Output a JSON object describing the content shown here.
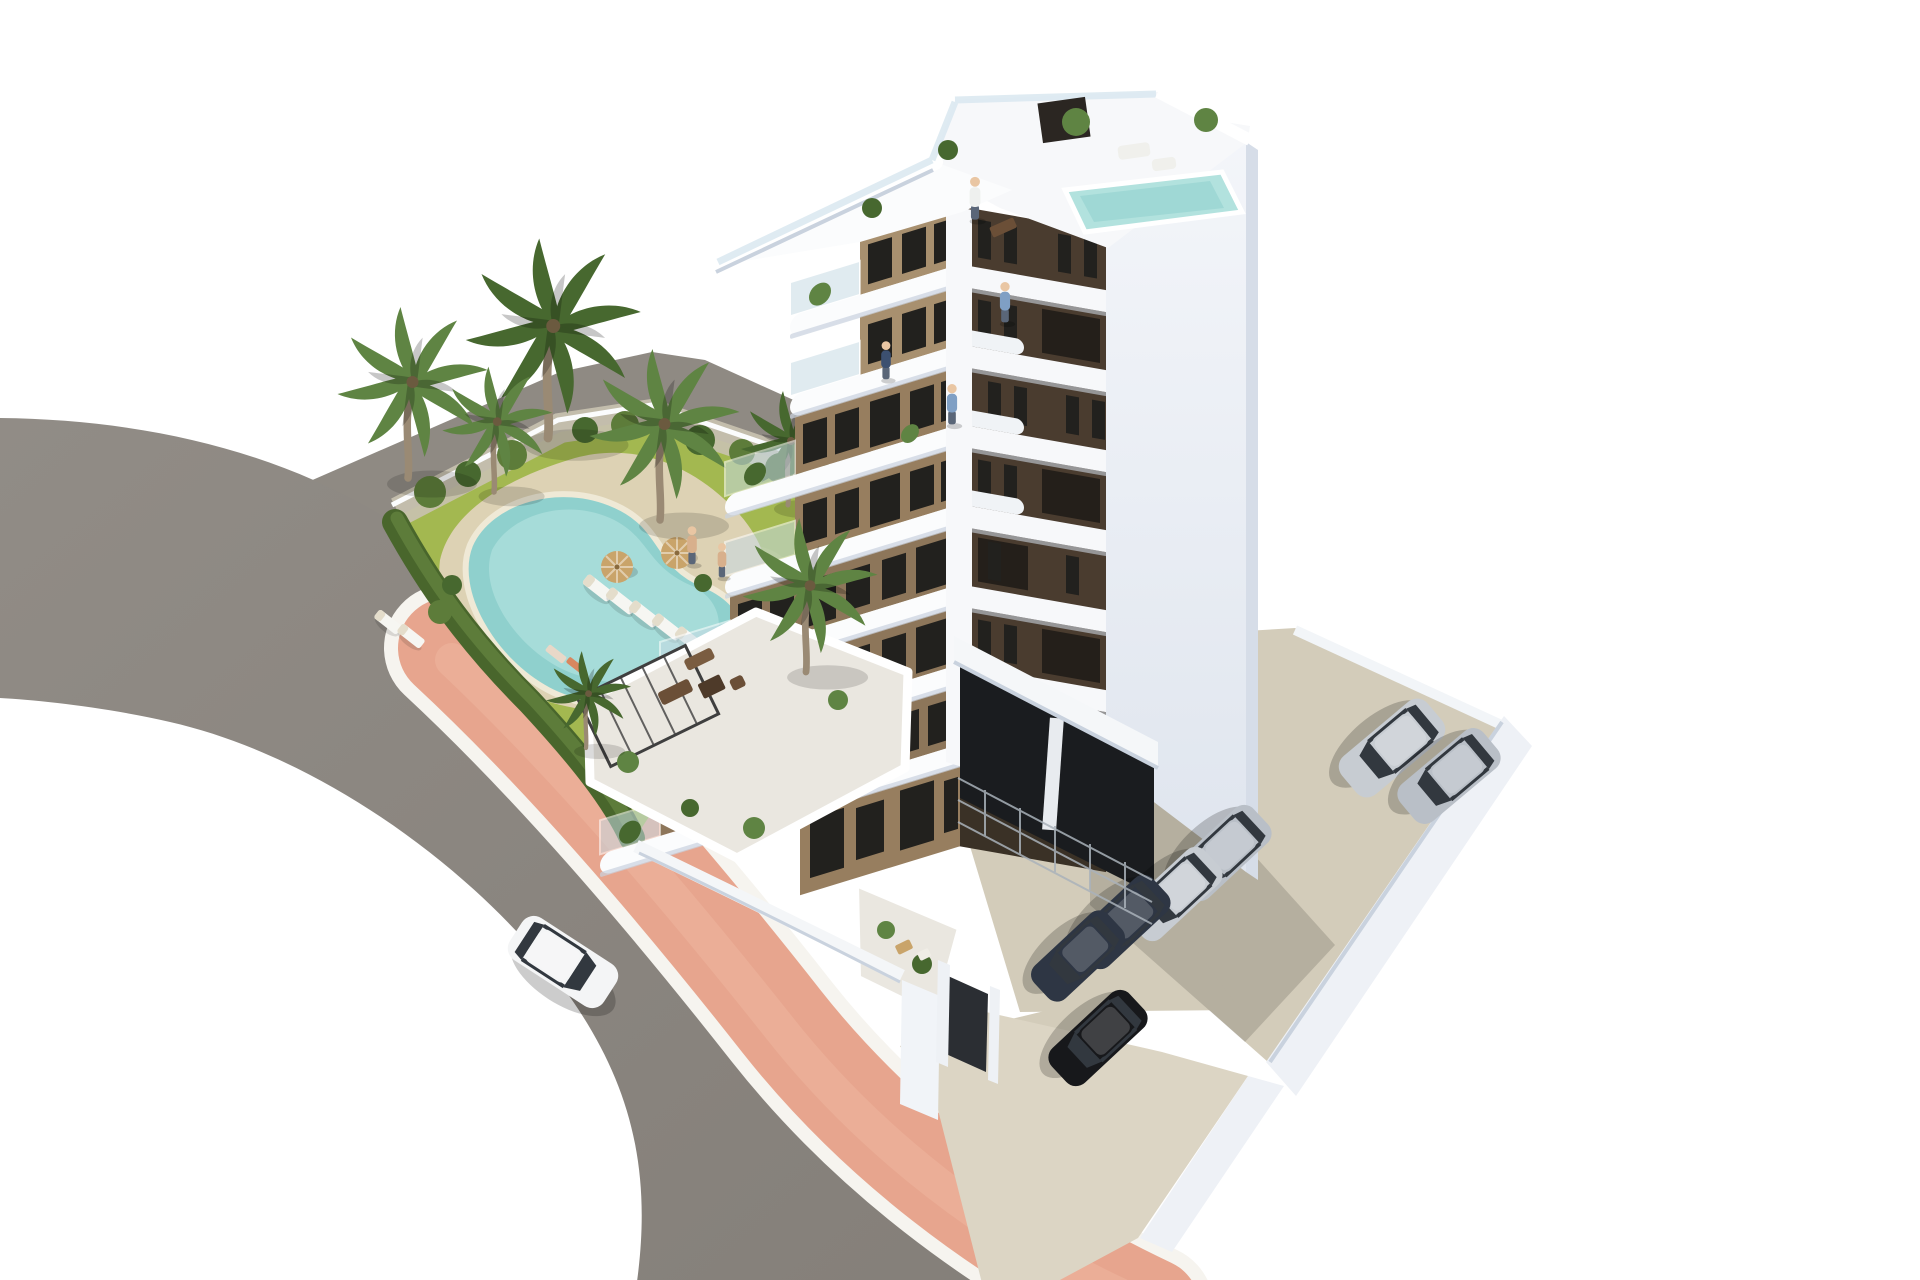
{
  "scene": {
    "type": "architectural-3d-render",
    "description": "Aerial 3D render of a modern 8-storey white and brown apartment building with stepped curved balconies, roof terraces with plunge pool, a landscaped garden with free-form swimming pool, sun loungers, parasols and palm trees, a curved asphalt road with pink sidewalk, a white car driving, and a walled parking court with parked cars and a semi-open garage."
  },
  "palette": {
    "bg": "#ffffff",
    "road": "#8b8680",
    "road_light": "#938e88",
    "strip": "#8f8a83",
    "sidewalk": "#e7a58e",
    "sidewalk_light": "#efb7a0",
    "curb": "#f6f4ef",
    "lawn": "#a3b850",
    "lawn_light": "#bcca6a",
    "gravel": "#c9c2b0",
    "hedge_dark": "#49662c",
    "hedge": "#5d7c3a",
    "deck": "#ddd2b4",
    "pool": "#8fd0cd",
    "pool_light": "#b2e2de",
    "pool_rim": "#efe9d6",
    "palm": "#5f8443",
    "palm_dark": "#47682f",
    "trunk": "#9a8a74",
    "white_wall": "#f7f8fa",
    "white_shade": "#c9d2de",
    "side_wall": "#eef1f6",
    "side_wall_shade": "#d6dde8",
    "tan": "#977e5f",
    "tan_light": "#a8906f",
    "tan_deep": "#8d765a",
    "dark_face": "#4a3c2f",
    "dark_face_deep": "#3a3126",
    "window": "#22211e",
    "glass": "#c8dbe4",
    "terrace_floor": "#eae7e0",
    "garage": "#1a1c1f",
    "yard": "#d3ccba",
    "yard_light": "#dcd5c4",
    "car_white": "#f4f5f6",
    "car_silver": "#c7ccd2",
    "car_silver2": "#b9bfc7",
    "car_navy": "#2e3644",
    "car_black": "#17181b",
    "wood": "#6b4f37",
    "wood_light": "#7a5c40",
    "umbrella": "#c9a46a",
    "person_blue": "#7f9fc4",
    "person_white": "#eef0ee",
    "person_navy": "#3c5070",
    "person_tan": "#d8b08c"
  },
  "inventory": {
    "building_floors": 8,
    "roof_features": [
      "roof terrace",
      "plunge pool",
      "glass balustrades",
      "potted plants"
    ],
    "garden": {
      "swimming_pool": 1,
      "sun_loungers": 7,
      "parasols": 2,
      "palm_trees": 7,
      "hedge": true
    },
    "road": {
      "cars_driving": 1,
      "sidewalk_color": "pink"
    },
    "parking": {
      "cars_parked": 7,
      "garage": "semi-open with car stackers"
    }
  },
  "instances": [
    {
      "use": "tpl-lounger",
      "name": "sun-lounger",
      "layer": "layer-garden-furniture",
      "x": 598,
      "y": 588,
      "r": 38
    },
    {
      "use": "tpl-lounger",
      "name": "sun-lounger",
      "layer": "layer-garden-furniture",
      "x": 621,
      "y": 601,
      "r": 38
    },
    {
      "use": "tpl-lounger",
      "name": "sun-lounger",
      "layer": "layer-garden-furniture",
      "x": 644,
      "y": 614,
      "r": 38
    },
    {
      "use": "tpl-lounger",
      "name": "sun-lounger",
      "layer": "layer-garden-furniture",
      "x": 667,
      "y": 627,
      "r": 38
    },
    {
      "use": "tpl-lounger",
      "name": "sun-lounger",
      "layer": "layer-garden-furniture",
      "x": 690,
      "y": 640,
      "r": 38
    },
    {
      "use": "tpl-lounger",
      "name": "sun-lounger",
      "layer": "layer-garden-furniture",
      "x": 388,
      "y": 622,
      "r": 38,
      "s": 0.9
    },
    {
      "use": "tpl-lounger",
      "name": "sun-lounger",
      "layer": "layer-garden-furniture",
      "x": 411,
      "y": 636,
      "r": 38,
      "s": 0.9
    },
    {
      "use": "tpl-umbrella",
      "name": "parasol",
      "layer": "layer-garden-furniture",
      "x": 617,
      "y": 567,
      "fill": "umbrella"
    },
    {
      "use": "tpl-umbrella",
      "name": "parasol",
      "layer": "layer-garden-furniture",
      "x": 677,
      "y": 553,
      "fill": "umbrella"
    },
    {
      "use": "tpl-palm",
      "name": "palm-tree",
      "layer": "layer-garden-flora",
      "x": 408,
      "y": 478,
      "s": 1.5,
      "fill": "palm"
    },
    {
      "use": "tpl-palm",
      "name": "palm-tree",
      "layer": "layer-garden-flora",
      "x": 548,
      "y": 438,
      "s": 1.75,
      "fill": "palm_dark"
    },
    {
      "use": "tpl-palm",
      "name": "palm-tree",
      "layer": "layer-garden-flora",
      "x": 494,
      "y": 492,
      "s": 1.1,
      "fill": "palm"
    },
    {
      "use": "tpl-palm",
      "name": "palm-tree",
      "layer": "layer-garden-flora",
      "x": 660,
      "y": 520,
      "s": 1.5,
      "fill": "palm"
    },
    {
      "use": "tpl-palm",
      "name": "palm-tree",
      "layer": "layer-garden-flora",
      "x": 788,
      "y": 505,
      "s": 1.0,
      "fill": "palm_dark"
    },
    {
      "use": "tpl-palm",
      "name": "palm-tree",
      "layer": "layer-front-flora",
      "x": 806,
      "y": 672,
      "s": 1.35,
      "fill": "palm"
    },
    {
      "use": "tpl-palm",
      "name": "palm-tree",
      "layer": "layer-front-flora",
      "x": 586,
      "y": 748,
      "s": 0.85,
      "fill": "palm_dark"
    },
    {
      "use": "tpl-car",
      "name": "driving-car-white",
      "layer": "layer-road-car",
      "x": 563,
      "y": 962,
      "r": 33,
      "fill": "car_white"
    },
    {
      "use": "tpl-car",
      "name": "parked-car-silver",
      "layer": "layer-yard-cars",
      "x": 1392,
      "y": 748,
      "r": 140,
      "fill": "car_silver"
    },
    {
      "use": "tpl-car",
      "name": "parked-car-silver",
      "layer": "layer-yard-cars",
      "x": 1449,
      "y": 776,
      "r": 140,
      "s": 0.97,
      "fill": "car_silver2"
    },
    {
      "use": "tpl-car",
      "name": "garage-car-silver",
      "layer": "layer-garage-cars",
      "x": 1222,
      "y": 853,
      "r": 137,
      "s": 0.95,
      "fill": "car_silver2"
    },
    {
      "use": "tpl-car",
      "name": "garage-car-silver",
      "layer": "layer-garage-cars",
      "x": 1174,
      "y": 894,
      "r": 137,
      "s": 0.93,
      "fill": "car_silver"
    },
    {
      "use": "tpl-car",
      "name": "garage-car-navy",
      "layer": "layer-garage-cars",
      "x": 1122,
      "y": 922,
      "r": 137,
      "s": 0.93,
      "fill": "car_navy"
    },
    {
      "use": "tpl-car",
      "name": "garage-car-navy",
      "layer": "layer-garage-cars",
      "x": 1078,
      "y": 956,
      "r": 137,
      "s": 0.9,
      "fill": "car_navy"
    },
    {
      "use": "tpl-car",
      "name": "ramp-car-black",
      "layer": "layer-ramp-car",
      "x": 1098,
      "y": 1038,
      "r": 137,
      "s": 0.95,
      "fill": "car_black"
    },
    {
      "use": "tpl-person",
      "name": "person-roof-terrace",
      "layer": "layer-people",
      "x": 975,
      "y": 198,
      "s": 0.9,
      "fill": "person_white"
    },
    {
      "use": "tpl-person",
      "name": "person-balcony",
      "layer": "layer-people",
      "x": 1005,
      "y": 302,
      "s": 0.85,
      "fill": "person_blue"
    },
    {
      "use": "tpl-person",
      "name": "person-balcony",
      "layer": "layer-people",
      "x": 952,
      "y": 404,
      "s": 0.85,
      "fill": "person_blue"
    },
    {
      "use": "tpl-person",
      "name": "person-terrace",
      "layer": "layer-people",
      "x": 886,
      "y": 360,
      "s": 0.8,
      "fill": "person_navy"
    },
    {
      "use": "tpl-person",
      "name": "person-poolside",
      "layer": "layer-people",
      "x": 692,
      "y": 545,
      "s": 0.8,
      "fill": "person_tan"
    },
    {
      "use": "tpl-person",
      "name": "person-poolside",
      "layer": "layer-people",
      "x": 722,
      "y": 560,
      "s": 0.72,
      "fill": "person_tan"
    }
  ]
}
